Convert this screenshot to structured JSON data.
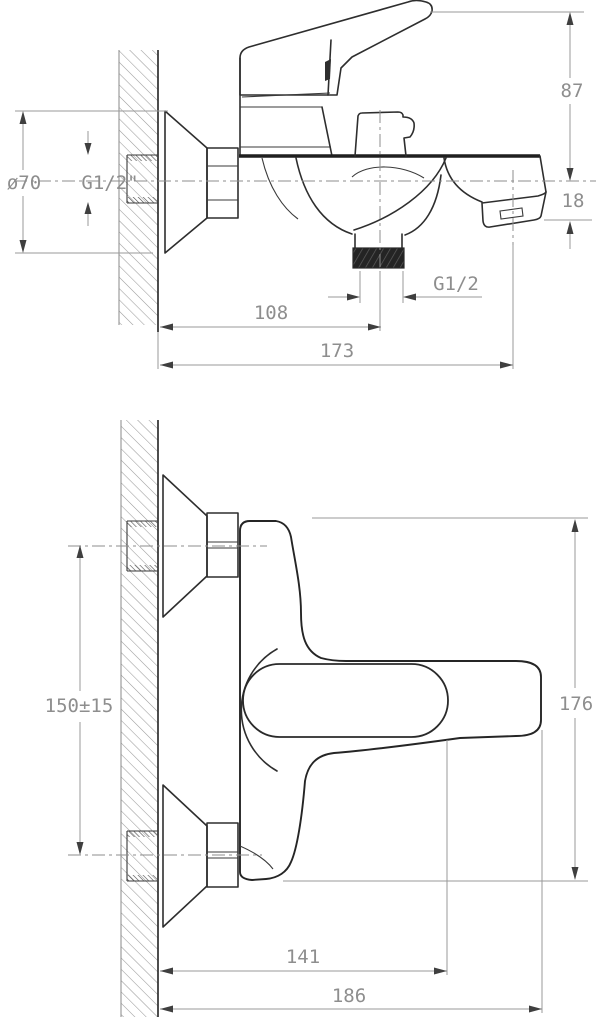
{
  "drawing": {
    "colors": {
      "object_line": "#2e2e2e",
      "dimension_line": "#999999",
      "dimension_text": "#8e8e8e",
      "background": "#ffffff"
    },
    "side_view": {
      "dims": {
        "handle_height": "87",
        "flange_diameter": "ø70",
        "wall_inlet_thread": "G1/2\"",
        "spout_drop": "18",
        "shower_outlet_thread": "G1/2",
        "wall_to_shower_outlet": "108",
        "total_projection": "173"
      }
    },
    "front_view": {
      "dims": {
        "inlet_spacing": "150±15",
        "overall_height": "176",
        "wall_to_handle_grip": "141",
        "overall_width": "186"
      }
    }
  }
}
